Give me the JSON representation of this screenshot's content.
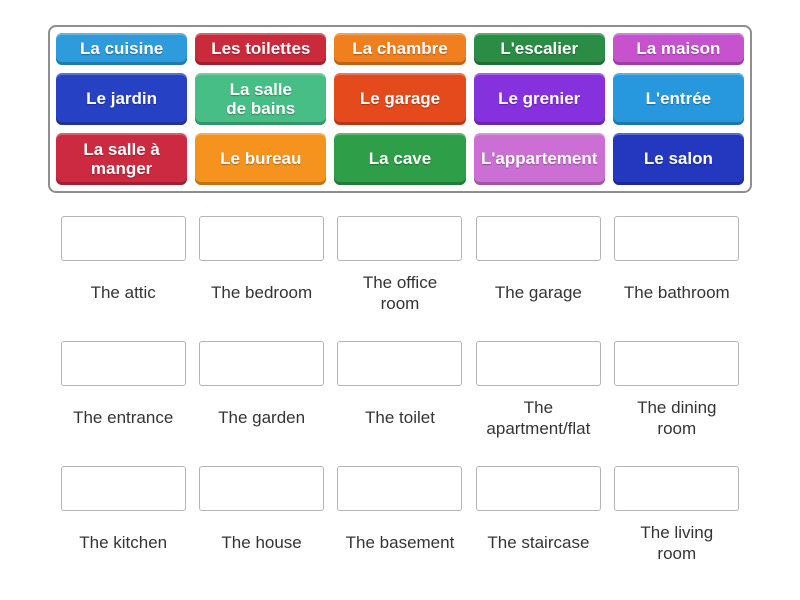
{
  "page": {
    "background": "#ffffff"
  },
  "word_bank": {
    "tiles": [
      {
        "label": "La cuisine",
        "color": "#2e9bdc"
      },
      {
        "label": "Les toilettes",
        "color": "#cb2a3d"
      },
      {
        "label": "La chambre",
        "color": "#f0801f"
      },
      {
        "label": "L'escalier",
        "color": "#2b8c46"
      },
      {
        "label": "La maison",
        "color": "#c653cd"
      },
      {
        "label": "Le jardin",
        "color": "#2741c4"
      },
      {
        "label": "La salle\nde bains",
        "color": "#47be85"
      },
      {
        "label": "Le garage",
        "color": "#e44a1c"
      },
      {
        "label": "Le grenier",
        "color": "#8531de"
      },
      {
        "label": "L'entrée",
        "color": "#2798dd"
      },
      {
        "label": "La salle à\nmanger",
        "color": "#cc2a41"
      },
      {
        "label": "Le bureau",
        "color": "#f6931e"
      },
      {
        "label": "La cave",
        "color": "#2e9e48"
      },
      {
        "label": "L'appartement",
        "color": "#cc6fd4"
      },
      {
        "label": "Le salon",
        "color": "#2338be"
      }
    ]
  },
  "answer_area": {
    "groups": [
      {
        "items": [
          {
            "label": "The attic"
          },
          {
            "label": "The bedroom"
          },
          {
            "label": "The office\nroom"
          },
          {
            "label": "The garage"
          },
          {
            "label": "The bathroom"
          }
        ]
      },
      {
        "items": [
          {
            "label": "The entrance"
          },
          {
            "label": "The garden"
          },
          {
            "label": "The toilet"
          },
          {
            "label": "The\napartment/flat"
          },
          {
            "label": "The dining\nroom"
          }
        ]
      },
      {
        "items": [
          {
            "label": "The kitchen"
          },
          {
            "label": "The house"
          },
          {
            "label": "The basement"
          },
          {
            "label": "The staircase"
          },
          {
            "label": "The living\nroom"
          }
        ]
      }
    ]
  }
}
